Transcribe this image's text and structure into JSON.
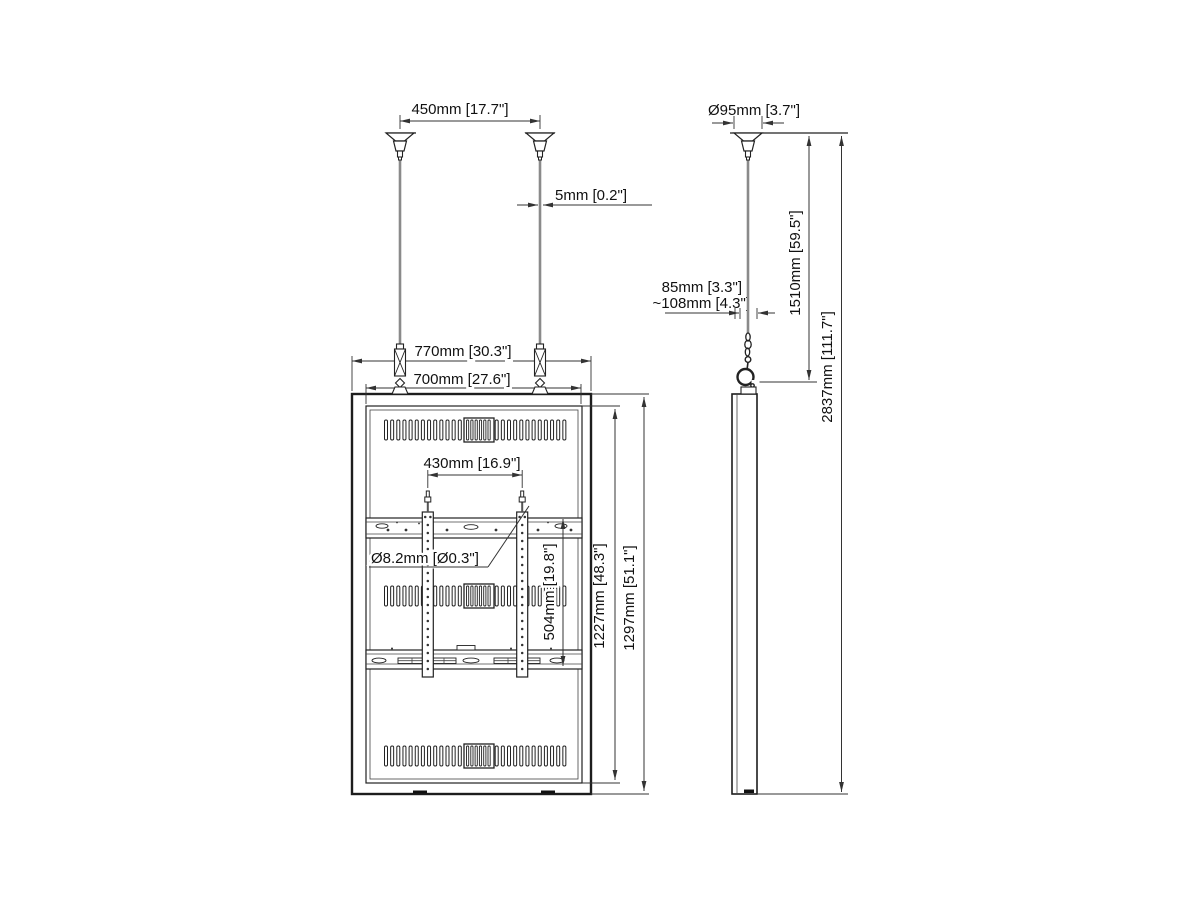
{
  "front_view": {
    "mount_spacing": "450mm [17.7\"]",
    "cable_diameter": "5mm [0.2\"]",
    "outer_width": "770mm [30.3\"]",
    "inner_width": "700mm [27.6\"]",
    "bracket_spacing": "430mm [16.9\"]",
    "hole_diameter": "Ø8.2mm [Ø0.3\"]",
    "bracket_height": "504mm [19.8\"]",
    "inner_height": "1227mm [48.3\"]",
    "outer_height": "1297mm [51.1\"]"
  },
  "side_view": {
    "mount_diameter": "Ø95mm [3.7\"]",
    "panel_depth": "85mm [3.3\"]",
    "overall_depth": "~108mm [4.3\"]",
    "suspension_drop": "1510mm [59.5\"]",
    "overall_height": "2837mm [111.7\"]"
  },
  "colors": {
    "line": "#222222",
    "cable": "#8a8a8a",
    "background": "#ffffff"
  }
}
